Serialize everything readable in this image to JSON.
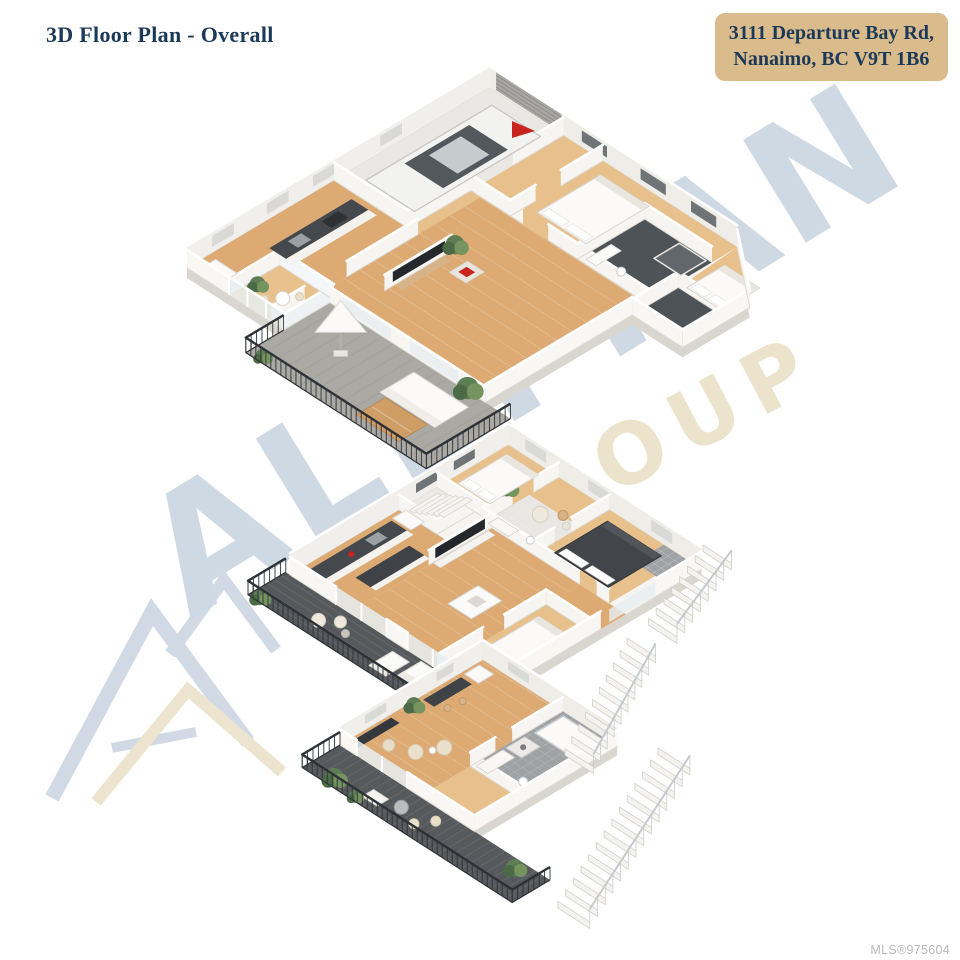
{
  "header": {
    "title": "3D Floor Plan - Overall",
    "address_line1": "3111 Departure Bay Rd,",
    "address_line2": "Nanaimo, BC V9T 1B6"
  },
  "watermark": {
    "brand": "ALLYTAN",
    "word": "GROUP"
  },
  "footer": {
    "mls_label": "MLS®975604"
  },
  "icons": {
    "north_marker": "red-flag",
    "logo_mark": "double-triangle-arrow"
  },
  "colors": {
    "title_navy": "#1c3a58",
    "badge_tan": "#d9bb8c",
    "mls_gray": "#b9b9b9",
    "watermark_blue": "#cfd9e3",
    "watermark_beige": "#ece3cc",
    "wall_white": "#f7f5f2",
    "wall_far": "#f1efeb",
    "wall_near": "#f8f7f4",
    "slab_top": "#f6f4f1",
    "slab_side": "#d9d6d0",
    "wood": "#dcaa72",
    "wood_light": "#e7c08c",
    "deck_dark": "#55595c",
    "deck_light": "#aaa9a4",
    "railing_dark": "#2e3237",
    "tile_gray": "#9ea2a4",
    "dark_floor": "#4e5357",
    "furniture_dark": "#42464a",
    "counter_dark": "#45494d",
    "plant_green": "#5f7d55",
    "flag_red": "#c8231d",
    "stair_white": "#f4f3f0"
  }
}
